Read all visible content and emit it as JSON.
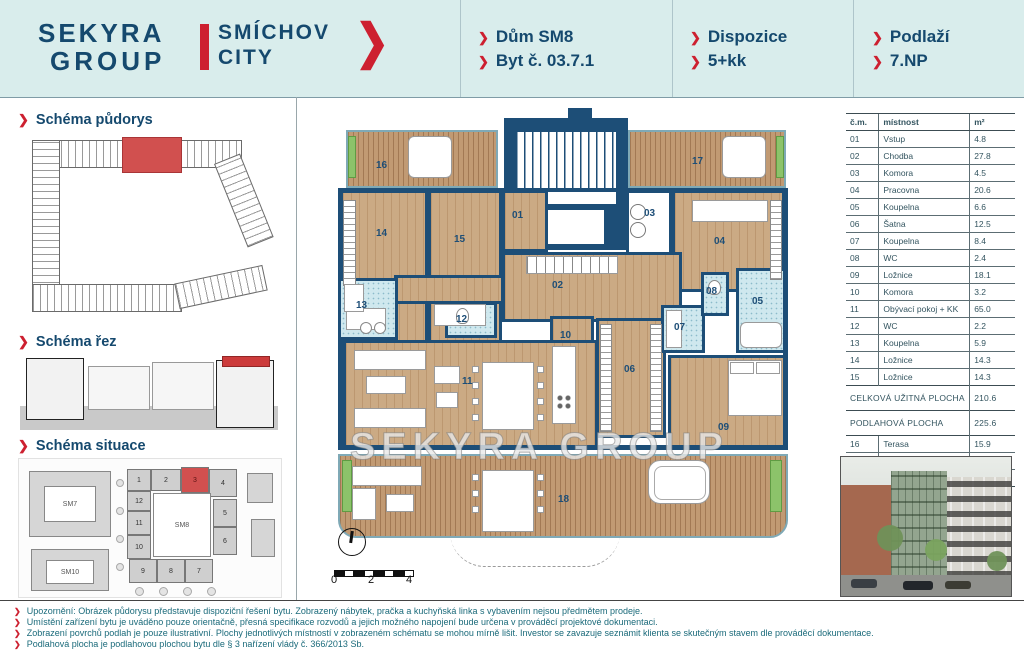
{
  "header": {
    "logo": {
      "line1": "SEKYRA",
      "line2": "GROUP",
      "brand1": "SMÍCHOV",
      "brand2": "CITY",
      "chevron": "❯"
    },
    "info": [
      {
        "lines": [
          "Dům SM8",
          "Byt č. 03.7.1"
        ]
      },
      {
        "lines": [
          "Dispozice",
          "5+kk"
        ]
      },
      {
        "lines": [
          "Podlaží",
          "7.NP"
        ]
      }
    ]
  },
  "sidebar": {
    "sections": [
      {
        "title": "Schéma půdorys"
      },
      {
        "title": "Schéma řez"
      },
      {
        "title": "Schéma situace"
      }
    ],
    "situace": {
      "blocks": {
        "sm7": "SM7",
        "sm8": "SM8",
        "sm10": "SM10"
      },
      "cells": [
        "1",
        "2",
        "3",
        "4",
        "5",
        "6",
        "7",
        "8",
        "9",
        "10",
        "11",
        "12"
      ]
    }
  },
  "plan": {
    "watermark": "SEKYRA GROUP",
    "rooms": {
      "r01": "01",
      "r02": "02",
      "r03": "03",
      "r04": "04",
      "r05": "05",
      "r06": "06",
      "r07": "07",
      "r08": "08",
      "r09": "09",
      "r10": "10",
      "r11": "11",
      "r12": "12",
      "r13": "13",
      "r14": "14",
      "r15": "15",
      "r16": "16",
      "r17": "17",
      "r18": "18"
    },
    "scale": {
      "labels": [
        "0",
        "2",
        "4"
      ]
    }
  },
  "table": {
    "columns": [
      "č.m.",
      "místnost",
      "m²"
    ],
    "rows": [
      {
        "no": "01",
        "name": "Vstup",
        "area": "4.8"
      },
      {
        "no": "02",
        "name": "Chodba",
        "area": "27.8"
      },
      {
        "no": "03",
        "name": "Komora",
        "area": "4.5"
      },
      {
        "no": "04",
        "name": "Pracovna",
        "area": "20.6"
      },
      {
        "no": "05",
        "name": "Koupelna",
        "area": "6.6"
      },
      {
        "no": "06",
        "name": "Šatna",
        "area": "12.5"
      },
      {
        "no": "07",
        "name": "Koupelna",
        "area": "8.4"
      },
      {
        "no": "08",
        "name": "WC",
        "area": "2.4"
      },
      {
        "no": "09",
        "name": "Ložnice",
        "area": "18.1"
      },
      {
        "no": "10",
        "name": "Komora",
        "area": "3.2"
      },
      {
        "no": "11",
        "name": "Obývací pokoj + KK",
        "area": "65.0"
      },
      {
        "no": "12",
        "name": "WC",
        "area": "2.2"
      },
      {
        "no": "13",
        "name": "Koupelna",
        "area": "5.9"
      },
      {
        "no": "14",
        "name": "Ložnice",
        "area": "14.3"
      },
      {
        "no": "15",
        "name": "Ložnice",
        "area": "14.3"
      },
      {
        "summary": true,
        "name": "CELKOVÁ UŽITNÁ PLOCHA",
        "area": "210.6"
      },
      {
        "summary": true,
        "name": "PODLAHOVÁ PLOCHA",
        "area": "225.6"
      },
      {
        "no": "16",
        "name": "Terasa",
        "area": "15.9",
        "group": true
      },
      {
        "no": "17",
        "name": "Terasa",
        "area": "16.7"
      },
      {
        "no": "18",
        "name": "Terasa",
        "area": "83.0"
      }
    ]
  },
  "footer": {
    "lines": [
      "Upozornění: Obrázek půdorysu představuje dispoziční řešení bytu. Zobrazený nábytek, pračka a kuchyňská linka s vybavením nejsou předmětem prodeje.",
      "Umístění zařízení bytu je uváděno pouze orientačně, přesná specifikace rozvodů a jejich možného napojení bude určena v prováděcí projektové dokumentaci.",
      "Zobrazení povrchů podlah je pouze ilustrativní. Plochy jednotlivých místností v zobrazeném schématu se mohou mírně lišit. Investor se zavazuje seznámit klienta se skutečným stavem dle prováděcí dokumentace.",
      "Podlahová plocha je podlahovou plochou bytu dle § 3 nařízení vlády č. 366/2013 Sb."
    ]
  }
}
